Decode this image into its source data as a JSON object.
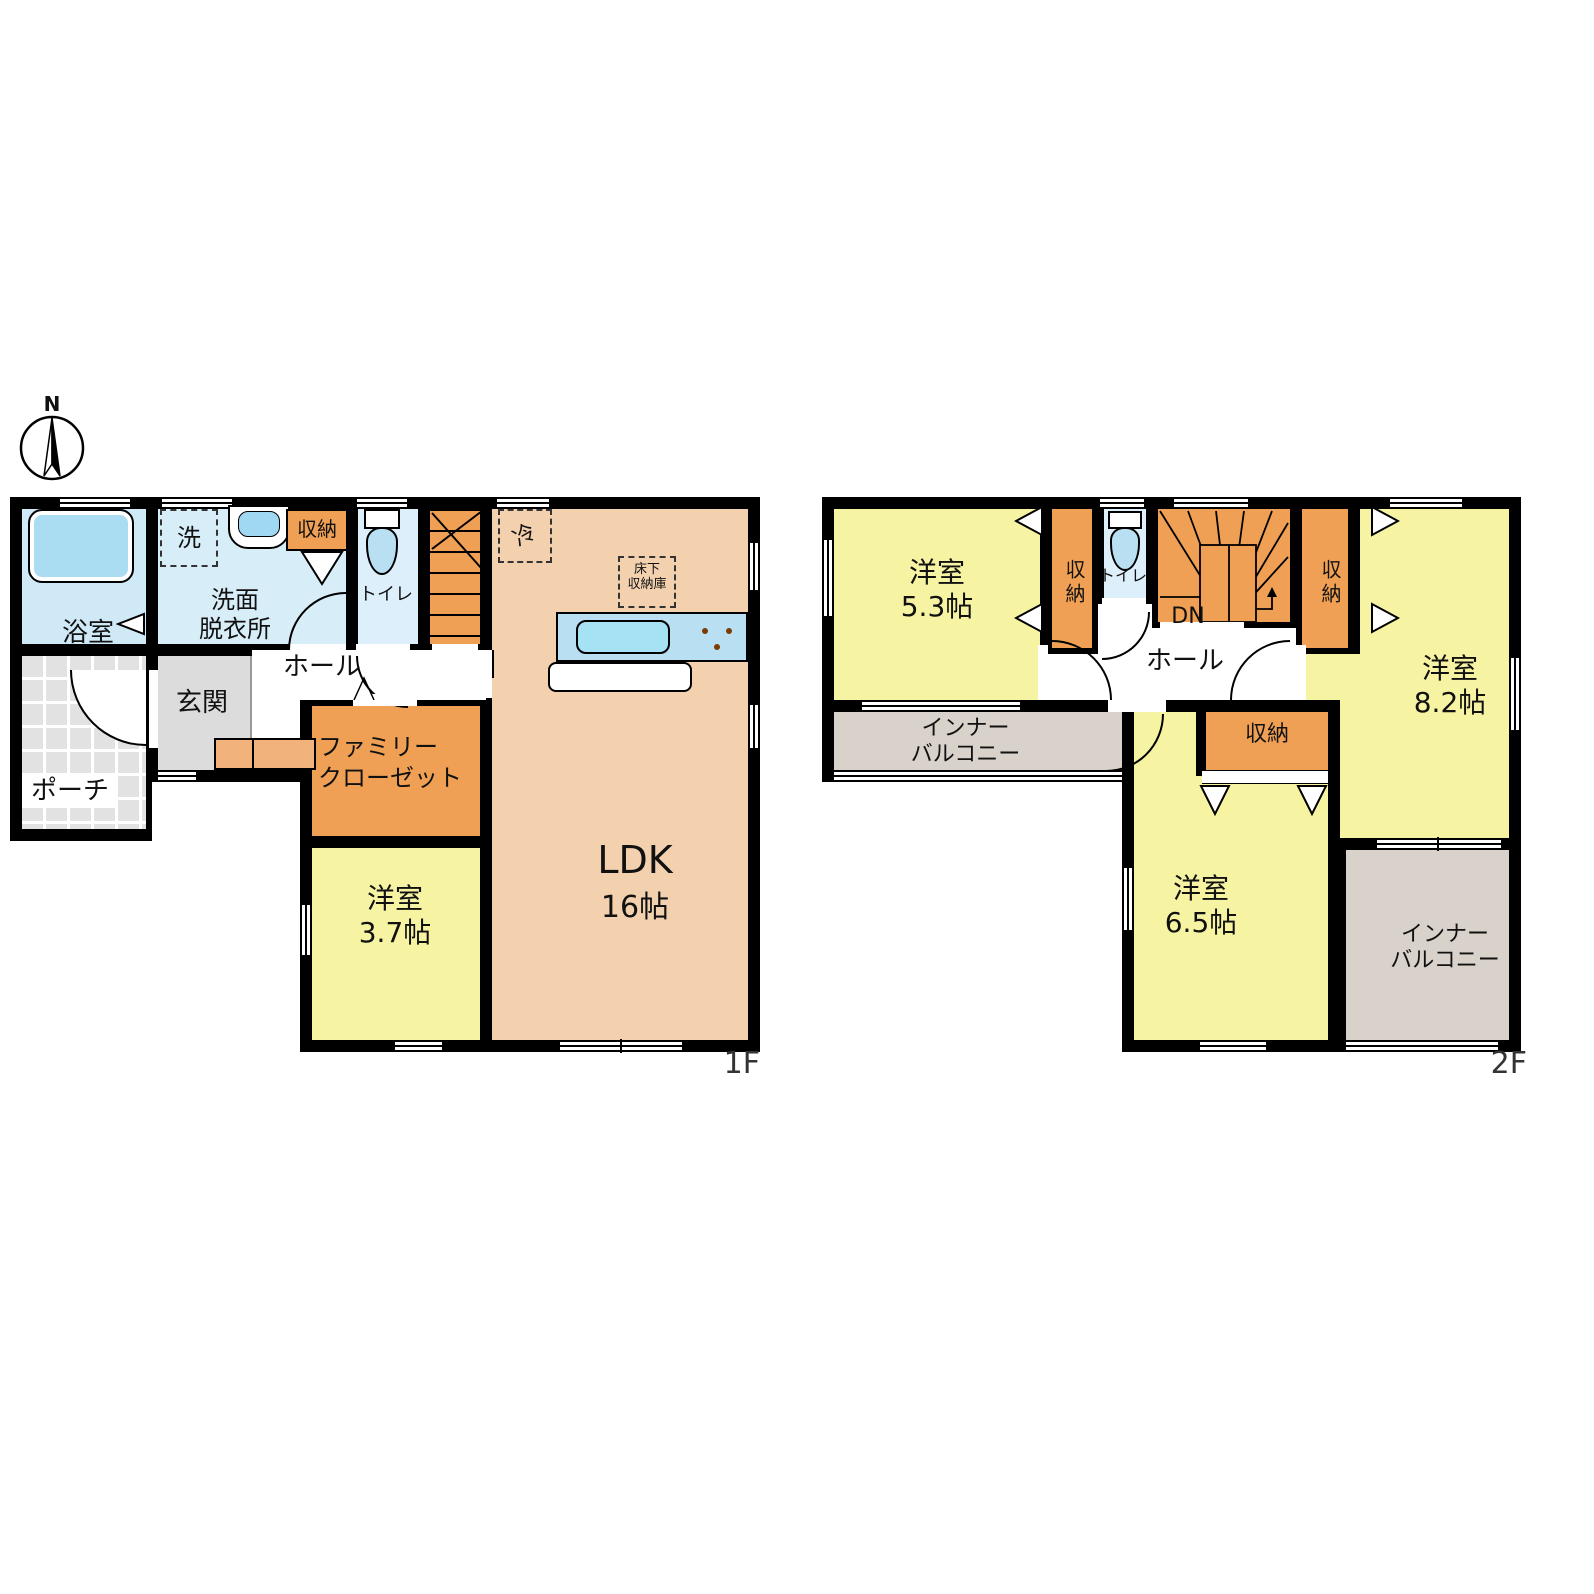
{
  "compass": {
    "north": "N"
  },
  "floor1": {
    "label": "1F",
    "bath": "浴室",
    "washer": "洗",
    "washroom": [
      "洗面",
      "脱衣所"
    ],
    "storage": "収納",
    "toilet": "トイレ",
    "hall": "ホール",
    "entrance": "玄関",
    "porch": "ポーチ",
    "family_closet": [
      "ファミリー",
      "クローゼット"
    ],
    "bedroom": [
      "洋室",
      "3.7帖"
    ],
    "ldk": [
      "LDK",
      "16帖"
    ],
    "fridge": "冷",
    "underfloor": [
      "床下",
      "収納庫"
    ]
  },
  "floor2": {
    "label": "2F",
    "bedroom1": [
      "洋室",
      "5.3帖"
    ],
    "storage_left": "収納",
    "toilet": "トイレ",
    "dn": "DN",
    "storage_right": "収納",
    "bedroom2": [
      "洋室",
      "8.2帖"
    ],
    "hall": "ホール",
    "inner_balcony_top": [
      "インナー",
      "バルコニー"
    ],
    "storage_hall": "収納",
    "bedroom3": [
      "洋室",
      "6.5帖"
    ],
    "inner_balcony_bottom": [
      "インナー",
      "バルコニー"
    ]
  },
  "palette": {
    "wall": "#000000",
    "yellow_room": "#f6f3a3",
    "peach_ldk": "#f3d1af",
    "orange_storage": "#efa054",
    "orange_step": "#f2b27c",
    "bath_blue": "#cfe9f6",
    "washroom_blue": "#d7edf8",
    "toilet_blue": "#ddeffa",
    "fixture_blue": "#aadcf2",
    "counter_blue": "#b9dff2",
    "balcony_gray": "#d9d2ca",
    "entrance_gray": "#dcdcdc",
    "porch_tile": "#e2e2e2"
  }
}
